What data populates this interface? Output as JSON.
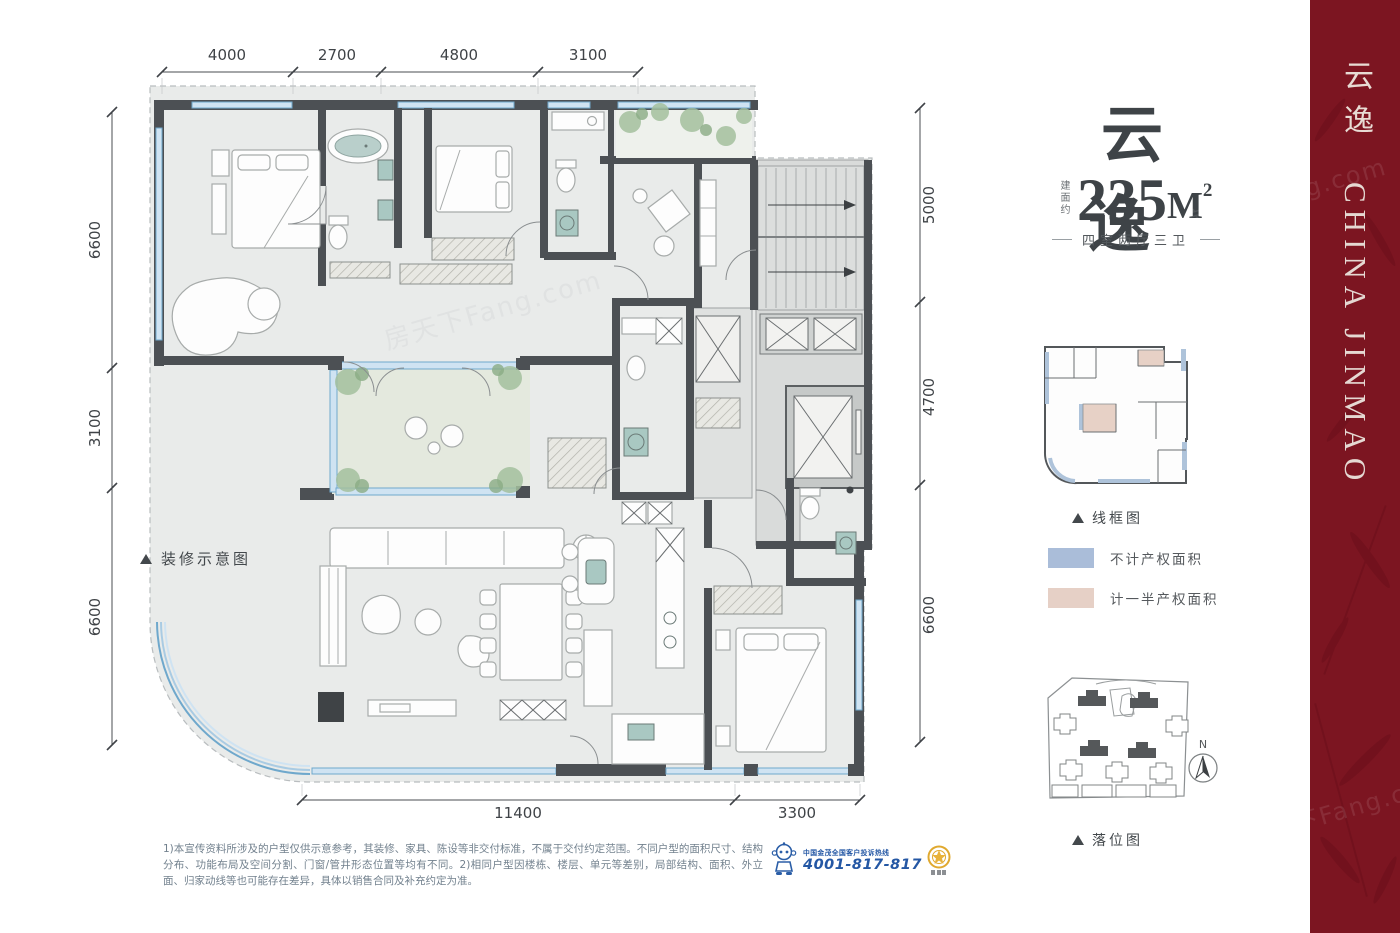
{
  "floor_plan": {
    "label": "装修示意图",
    "dimensions": {
      "top": [
        "4000",
        "2700",
        "4800",
        "3100"
      ],
      "left": [
        "6600",
        "3100",
        "6600"
      ],
      "right": [
        "5000",
        "4700",
        "6600"
      ],
      "bottom": [
        "11400",
        "3300"
      ]
    }
  },
  "info_panel": {
    "title": "云逸",
    "area_prefix": "建面约",
    "area_value": "235",
    "area_unit": "M",
    "area_sup": "2",
    "layout_text": "四室两厅三卫",
    "wireframe_label": "线框图",
    "legend": [
      {
        "label": "不计产权面积",
        "color": "#aabdd9"
      },
      {
        "label": "计一半产权面积",
        "color": "#e6d0c6"
      }
    ],
    "siteplan_label": "落位图",
    "compass_n": "N"
  },
  "sidebar": {
    "title_cn": "云逸",
    "title_en": "CHINA JINMAO",
    "bg_color": "#7c1521",
    "text_color": "#e8dbd4"
  },
  "footer": {
    "disclaimer": "1)本宣传资料所涉及的户型仅供示意参考，其装修、家具、陈设等非交付标准，不属于交付约定范围。不同户型的面积尺寸、结构分布、功能布局及空间分割、门窗/管井形态位置等均有不同。2)相同户型因楼栋、楼层、单元等差别，局部结构、面积、外立面、归家动线等也可能存在差异，具体以销售合同及补充约定为准。",
    "hotline_label": "中国金茂全国客户投诉热线",
    "hotline_number": "4001-817-817"
  },
  "colors": {
    "wall": "#4c5054",
    "window_blue": "#7fb2d6",
    "terrace_green": "#e4e9de",
    "core_gray": "#dcdedd",
    "title_text": "#3e4347",
    "hotline_blue": "#2457a4",
    "gold": "#e0a92f"
  },
  "watermark": {
    "text": "房天下Fang.com"
  }
}
